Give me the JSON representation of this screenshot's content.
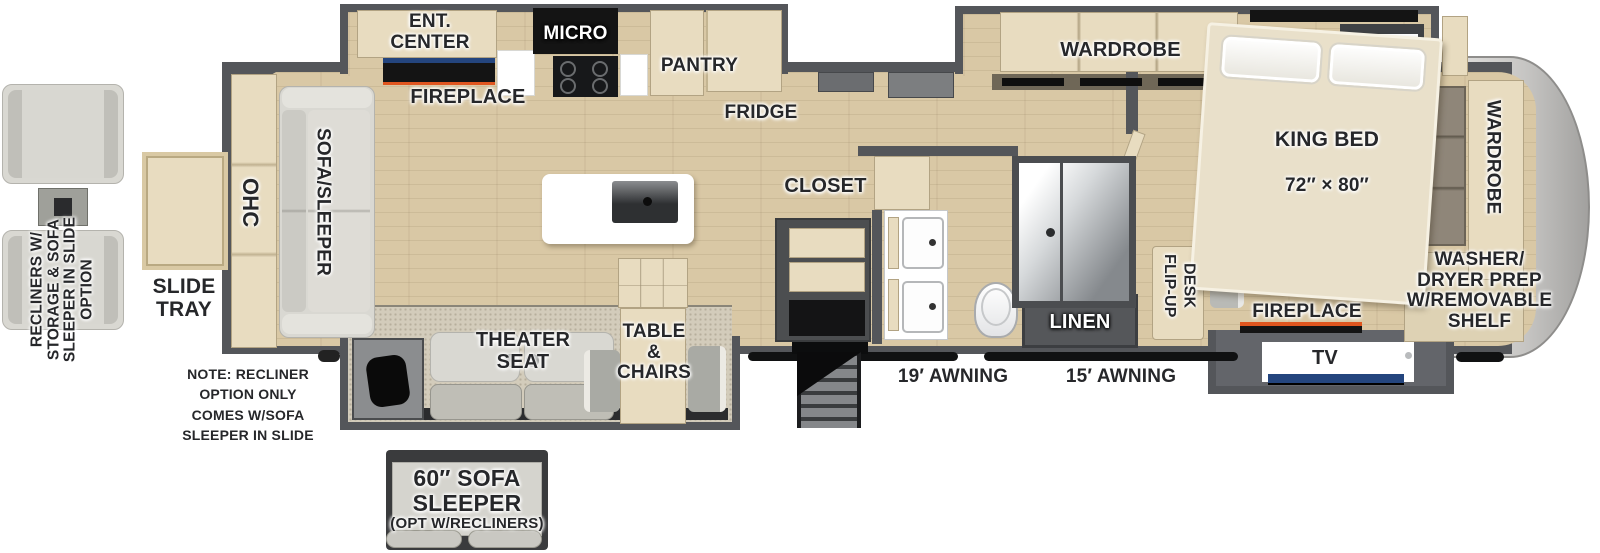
{
  "colors": {
    "floor": "#d9c8a5",
    "wall": "#54565a",
    "wall_dark": "#3c3e41",
    "cabinet": "#e8dcc0",
    "cabinet_border": "#b2a383",
    "carpet": "#d3ccbb",
    "sofa": "#d9d8d2",
    "accent_blue": "#24457e",
    "accent_orange": "#e0561f",
    "label": "#26272a",
    "cap": "#c6c5c3"
  },
  "labels": {
    "kitchen": {
      "ent_center": "ENT.\nCENTER",
      "fireplace": "FIREPLACE",
      "micro": "MICRO",
      "pantry": "PANTRY",
      "fridge": "FRIDGE"
    },
    "living": {
      "ohc": "OHC",
      "sofa_sleeper": "SOFA/SLEEPER",
      "theater_seat": "THEATER\nSEAT",
      "table_chairs": "TABLE\n&\nCHAIRS"
    },
    "bath": {
      "closet": "CLOSET",
      "linen": "LINEN"
    },
    "bedroom": {
      "wardrobe": "WARDROBE",
      "king_bed": "KING BED",
      "king_bed_size": "72″ × 80″",
      "flip_up_desk": "FLIP-UP\nDESK",
      "fireplace": "FIREPLACE",
      "tv": "TV"
    },
    "front": {
      "wardrobe": "WARDROBE",
      "washer_dryer": "WASHER/\nDRYER PREP\nW/REMOVABLE\nSHELF"
    },
    "exterior": {
      "awning_19": "19′ AWNING",
      "awning_15": "15′ AWNING",
      "slide_tray": "SLIDE\nTRAY"
    },
    "options": {
      "recliners": "RECLINERS W/\nSTORAGE & SOFA\nSLEEPER IN SLIDE\nOPTION",
      "note": "NOTE: RECLINER\nOPTION ONLY\nCOMES W/SOFA\nSLEEPER IN SLIDE",
      "sofa_sleeper_title": "60″ SOFA\nSLEEPER",
      "sofa_sleeper_sub": "(OPT W/RECLINERS)"
    }
  }
}
